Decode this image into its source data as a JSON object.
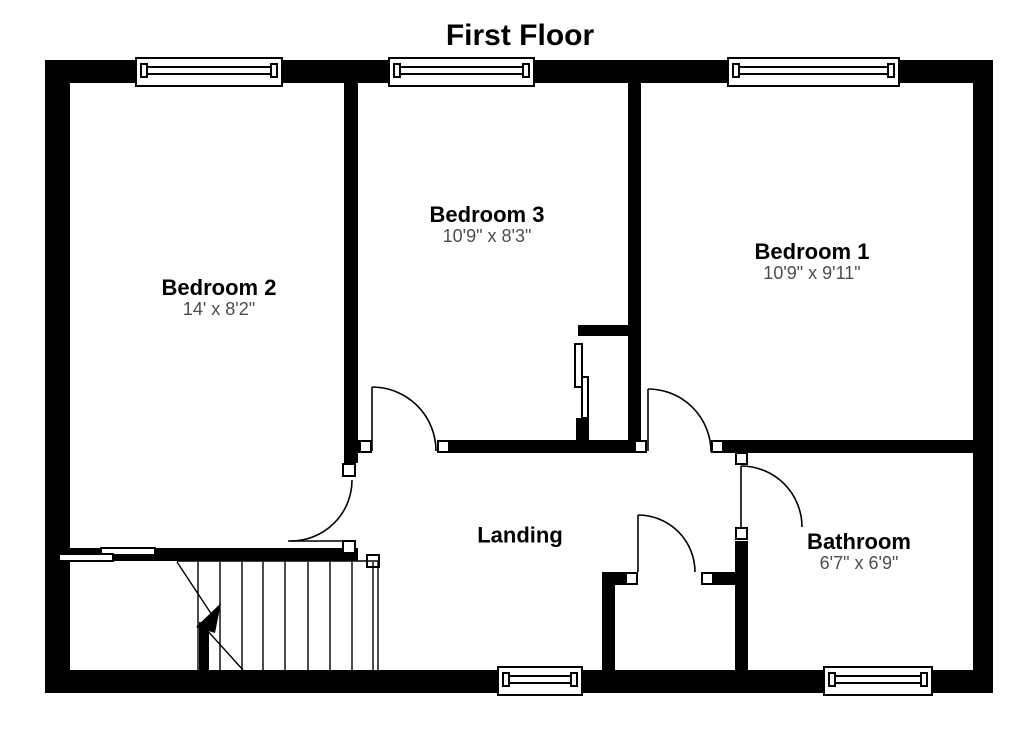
{
  "title": "First Floor",
  "rooms": {
    "bedroom2": {
      "name": "Bedroom 2",
      "dims": "14' x 8'2\""
    },
    "bedroom3": {
      "name": "Bedroom 3",
      "dims": "10'9\" x 8'3\""
    },
    "bedroom1": {
      "name": "Bedroom 1",
      "dims": "10'9\" x 9'11\""
    },
    "landing": {
      "name": "Landing",
      "dims": ""
    },
    "bathroom": {
      "name": "Bathroom",
      "dims": "6'7\" x 6'9\""
    }
  },
  "colors": {
    "wall": "#000000",
    "background": "#ffffff",
    "room_name_text": "#000000",
    "dimension_text": "#4d4d4d"
  },
  "features": {
    "windows": 5,
    "doors": 5,
    "staircase": 1
  }
}
